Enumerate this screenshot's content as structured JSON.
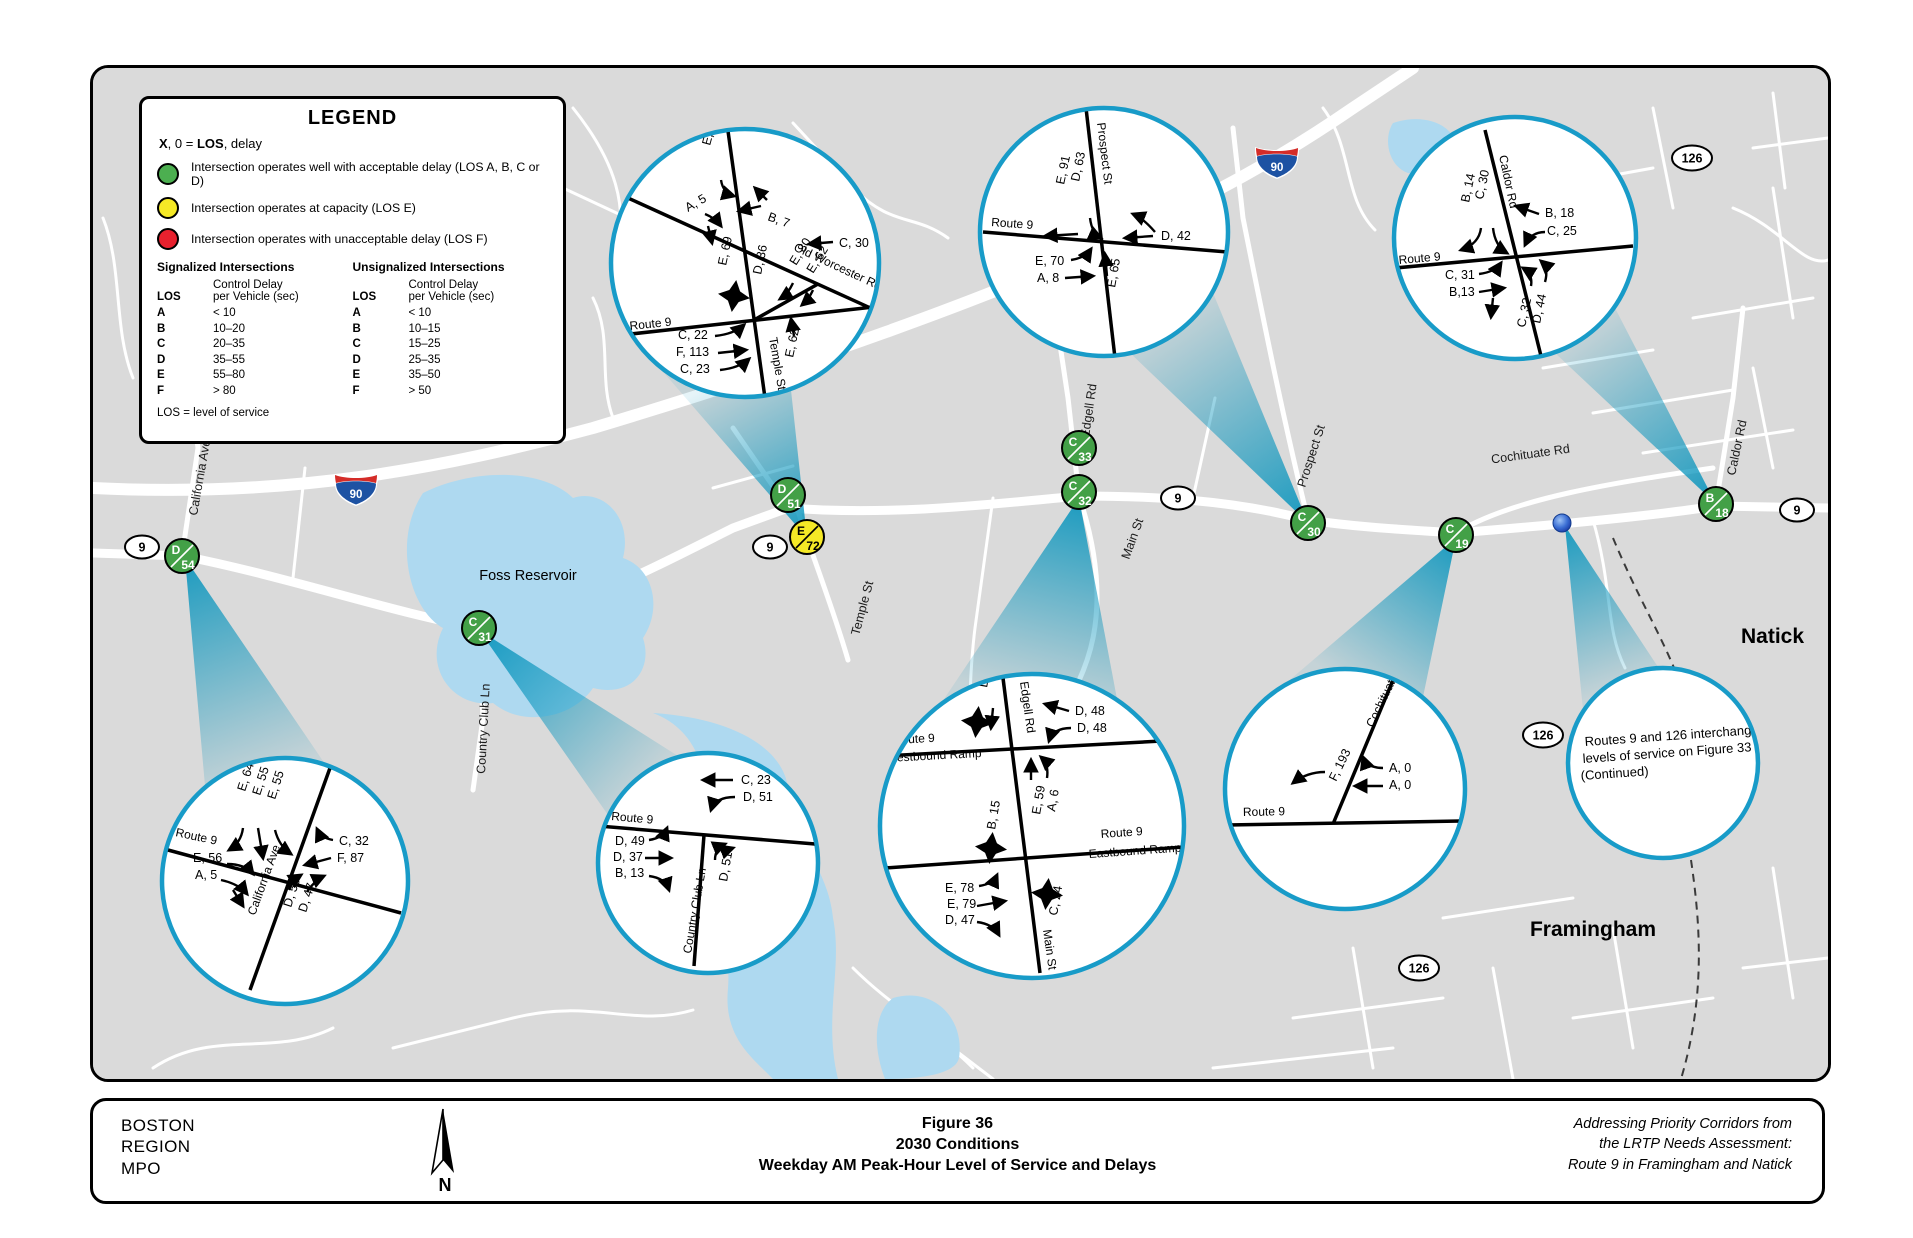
{
  "legend": {
    "title": "LEGEND",
    "key": {
      "symbol": "X",
      "mid": ", 0  =  ",
      "term": "LOS",
      "rest": ", delay"
    },
    "items": [
      {
        "label": "Intersection operates well with acceptable delay (LOS A, B, C or D)",
        "color": "#4caf50"
      },
      {
        "label": "Intersection operates at capacity (LOS E)",
        "color": "#f5e926"
      },
      {
        "label": "Intersection operates with unacceptable delay (LOS F)",
        "color": "#e8212e"
      }
    ],
    "signalized": {
      "heading": "Signalized Intersections",
      "los_col": "LOS",
      "delay_line1": "Control Delay",
      "delay_line2": "per Vehicle (sec)",
      "rows": [
        {
          "los": "A",
          "delay": "< 10"
        },
        {
          "los": "B",
          "delay": "10–20"
        },
        {
          "los": "C",
          "delay": "20–35"
        },
        {
          "los": "D",
          "delay": "35–55"
        },
        {
          "los": "E",
          "delay": "55–80"
        },
        {
          "los": "F",
          "delay": "> 80"
        }
      ]
    },
    "unsignalized": {
      "heading": "Unsignalized Intersections",
      "los_col": "LOS",
      "delay_line1": "Control Delay",
      "delay_line2": "per Vehicle (sec)",
      "rows": [
        {
          "los": "A",
          "delay": "< 10"
        },
        {
          "los": "B",
          "delay": "10–15"
        },
        {
          "los": "C",
          "delay": "15–25"
        },
        {
          "los": "D",
          "delay": "25–35"
        },
        {
          "los": "E",
          "delay": "35–50"
        },
        {
          "los": "F",
          "delay": "> 50"
        }
      ]
    },
    "footnote": "LOS = level of service"
  },
  "map": {
    "water_label": "Foss Reservoir",
    "towns": {
      "natick": "Natick",
      "framingham": "Framingham"
    },
    "streets": {
      "california": "California Ave",
      "country_club": "Country Club Ln",
      "temple": "Temple St",
      "main": "Main St",
      "edgell": "Edgell Rd",
      "prospect": "Prospect St",
      "cochituate": "Cochituate Rd",
      "caldor": "Caldor Rd"
    },
    "shields": {
      "route9": "9",
      "route126": "126",
      "interstate": "90"
    },
    "badges": [
      {
        "los": "D",
        "delay": "54",
        "status": "green"
      },
      {
        "los": "C",
        "delay": "31",
        "status": "green"
      },
      {
        "los": "D",
        "delay": "51",
        "status": "green"
      },
      {
        "los": "E",
        "delay": "72",
        "status": "yellow"
      },
      {
        "los": "C",
        "delay": "33",
        "status": "green"
      },
      {
        "los": "C",
        "delay": "32",
        "status": "green"
      },
      {
        "los": "C",
        "delay": "30",
        "status": "green"
      },
      {
        "los": "C",
        "delay": "19",
        "status": "green"
      },
      {
        "los": "B",
        "delay": "18",
        "status": "green"
      }
    ]
  },
  "callouts": {
    "temple": {
      "roads": {
        "route9": "Route 9",
        "cross": "Temple St",
        "diag": "Old Worcester Rd"
      },
      "labels": [
        "E, 80",
        "A, 5",
        "B, 7",
        "C, 30",
        "E, 69",
        "D, 36",
        "E, 80",
        "E, 62",
        "C, 22",
        "F, 113",
        "C, 23",
        "E, 62"
      ]
    },
    "prospect": {
      "roads": {
        "route9": "Route 9",
        "cross": "Prospect St"
      },
      "labels": [
        "D, 63",
        "E, 91",
        "D, 42",
        "E, 70",
        "A, 8",
        "E, 65"
      ]
    },
    "caldor": {
      "roads": {
        "route9": "Route 9",
        "cross": "Caldor Rd"
      },
      "labels": [
        "C, 30",
        "B, 14",
        "B, 18",
        "C, 25",
        "C, 31",
        "B,13",
        "D, 44",
        "C, 32"
      ]
    },
    "california": {
      "roads": {
        "route9": "Route 9",
        "cross": "California Ave"
      },
      "labels": [
        "E, 64",
        "E, 55",
        "E, 55",
        "C, 32",
        "F, 87",
        "E, 56",
        "A, 5",
        "D, 50",
        "D, 47"
      ]
    },
    "country_club": {
      "roads": {
        "route9": "Route 9",
        "cross": "Country Club Ln"
      },
      "labels": [
        "C, 23",
        "D, 51",
        "D, 49",
        "D, 37",
        "B, 13",
        "D, 51"
      ]
    },
    "edgell": {
      "roads": {
        "edgell": "Edgell Rd",
        "main": "Main St",
        "wb_route": "Route 9",
        "wb_ramp": "Westbound Ramp",
        "eb_route": "Route 9",
        "eb_ramp": "Eastbound Ramp"
      },
      "labels": [
        "D, 36",
        "D, 48",
        "D, 48",
        "A, 6",
        "E, 59",
        "B, 15",
        "E, 78",
        "E, 79",
        "D, 47",
        "C, 24"
      ]
    },
    "cochituate": {
      "roads": {
        "route9": "Route 9",
        "cross": "Cochituate Rd"
      },
      "labels": [
        "F, 193",
        "A, 0",
        "A, 0"
      ]
    },
    "note": {
      "lines": [
        "Routes 9 and 126 interchange",
        "levels of service on Figure 33",
        "(Continued)"
      ]
    }
  },
  "footer": {
    "org_lines": [
      "BOSTON",
      "REGION",
      "MPO"
    ],
    "north_label": "N",
    "title_lines": [
      "Figure 36",
      "2030 Conditions",
      "Weekday AM Peak-Hour Level of Service and Delays"
    ],
    "credit_lines": [
      "Addressing Priority Corridors from",
      "the LRTP Needs Assessment:",
      "Route 9 in Framingham and Natick"
    ]
  },
  "colors": {
    "map_background": "#dadada",
    "water": "#aed9f0",
    "callout_teal": "#189bc8",
    "beam_teal": "#0a95bd",
    "los_green": "#43a047",
    "los_yellow": "#f5e926",
    "los_red": "#e8212e"
  }
}
